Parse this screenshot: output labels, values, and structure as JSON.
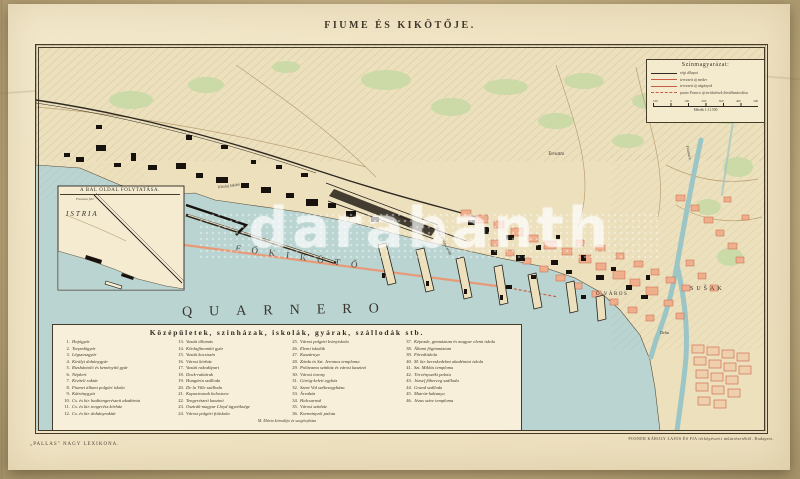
{
  "page_title": "FIUME ÉS KIKÖTŐJE.",
  "watermark": "darabanth",
  "colors": {
    "paper": "#f0e4c4",
    "sea": "#b9d4d1",
    "land": "#ece0bd",
    "city_block": "#f0af8c",
    "planned_red": "#c95c44",
    "ink": "#2e2822",
    "green": "#c8daa4"
  },
  "legend_box": {
    "title": "Színmagyarázat:",
    "rows": [
      {
        "cls": "s-black",
        "label": "régi állapot"
      },
      {
        "cls": "s-red",
        "label": "tervezett új meder"
      },
      {
        "cls": "s-red-thin",
        "label": "tervezett új vágányok"
      },
      {
        "cls": "s-red-dash",
        "label": "punto Franco új területének körülhatárolása"
      }
    ],
    "scale_ticks": [
      "100",
      "0",
      "100",
      "200",
      "300",
      "400",
      "500"
    ],
    "scale_caption": "Mérték 1:11.500"
  },
  "inset": {
    "title": "A BAL OLDAL FOLYTATÁSA.",
    "note": "Fianona felé",
    "region_label": "ISTRIA"
  },
  "sea_labels": {
    "harbor": "FŐKIKÖTŐ",
    "sea": "QUARNERO"
  },
  "map_labels": {
    "old_town": "Ó VÁROS",
    "susak": "SUŠAK",
    "tersatto": "Tersatto",
    "petroleum_port": "Kőolaj kikötő",
    "molo": "Mária Terézia móló",
    "river": "Fiumara",
    "delta": "Delta"
  },
  "legend_panel": {
    "title": "Középületek, szinházak, iskolák, gyárak, szállodák stb.",
    "columns": [
      [
        {
          "n": "1.",
          "label": "Hajógyár"
        },
        {
          "n": "2.",
          "label": "Torpedógyár"
        },
        {
          "n": "3.",
          "label": "Légszeszgyár"
        },
        {
          "n": "4.",
          "label": "Királyi dohánygyár"
        },
        {
          "n": "5.",
          "label": "Rizshántoló és keményítő gyár"
        },
        {
          "n": "6.",
          "label": "Népkert"
        },
        {
          "n": "7.",
          "label": "Kiviteli raktár"
        },
        {
          "n": "8.",
          "label": "Fiumei állami polgári iskola"
        },
        {
          "n": "9.",
          "label": "Kátránygyár"
        },
        {
          "n": "10.",
          "label": "Cs. és kir. haditengerészeti akadémia"
        },
        {
          "n": "11.",
          "label": "Cs. és kir. tengerész kórház"
        },
        {
          "n": "12.",
          "label": "Cs. és kir. dohányraktár"
        }
      ],
      [
        {
          "n": "13.",
          "label": "Vasúti állomás"
        },
        {
          "n": "14.",
          "label": "Kőolajfinomító gyár"
        },
        {
          "n": "15.",
          "label": "Vasúti kocsiszín"
        },
        {
          "n": "16.",
          "label": "Városi kórház"
        },
        {
          "n": "17.",
          "label": "Vasúti rakodópart"
        },
        {
          "n": "18.",
          "label": "Dock-raktárak"
        },
        {
          "n": "19.",
          "label": "Hungária szálloda"
        },
        {
          "n": "20.",
          "label": "De la Ville szálloda"
        },
        {
          "n": "21.",
          "label": "Kapucinusok kolostora"
        },
        {
          "n": "22.",
          "label": "Tengerészeti kaszinó"
        },
        {
          "n": "23.",
          "label": "Osztrák-magyar Lloyd ügynöksége"
        },
        {
          "n": "24.",
          "label": "Városi polgári fiúiskola"
        }
      ],
      [
        {
          "n": "25.",
          "label": "Városi polgári leányiskola"
        },
        {
          "n": "26.",
          "label": "Elemi iskolák"
        },
        {
          "n": "27.",
          "label": "Kaszárnya"
        },
        {
          "n": "28.",
          "label": "Zárda és Szt. Jeromos temploma"
        },
        {
          "n": "29.",
          "label": "Politeama színház és városi kaszinó"
        },
        {
          "n": "30.",
          "label": "Városi torony"
        },
        {
          "n": "31.",
          "label": "Görög-keleti egyház"
        },
        {
          "n": "32.",
          "label": "Szent Vid székesegyháza"
        },
        {
          "n": "33.",
          "label": "Árvaház"
        },
        {
          "n": "34.",
          "label": "Halcsarnok"
        },
        {
          "n": "35.",
          "label": "Városi színház"
        },
        {
          "n": "36.",
          "label": "Kormányzói palota"
        }
      ],
      [
        {
          "n": "37.",
          "label": "Képezde, gimnázium és magyar elemi iskola"
        },
        {
          "n": "38.",
          "label": "Állami főgimnázium"
        },
        {
          "n": "39.",
          "label": "Főreáliskola"
        },
        {
          "n": "40.",
          "label": "M. kir. kereskedelmi akadémiai iskola"
        },
        {
          "n": "41.",
          "label": "Szt. Miklós temploma"
        },
        {
          "n": "42.",
          "label": "Törvényszéki palota"
        },
        {
          "n": "43.",
          "label": "József főherceg szálloda"
        },
        {
          "n": "44.",
          "label": "Grand szálloda"
        },
        {
          "n": "45.",
          "label": "Matróz-laktanya"
        },
        {
          "n": "46.",
          "label": "Jézus szíve temploma"
        }
      ]
    ],
    "footnote": "M. Mária kórodája és szegényháza"
  },
  "credits": {
    "left": "„PALLAS\" NAGY LEXIKONA.",
    "right": "POSNER KÁROLY LAJOS ÉS FIA térképészeti műintézetéből, Budapest."
  }
}
